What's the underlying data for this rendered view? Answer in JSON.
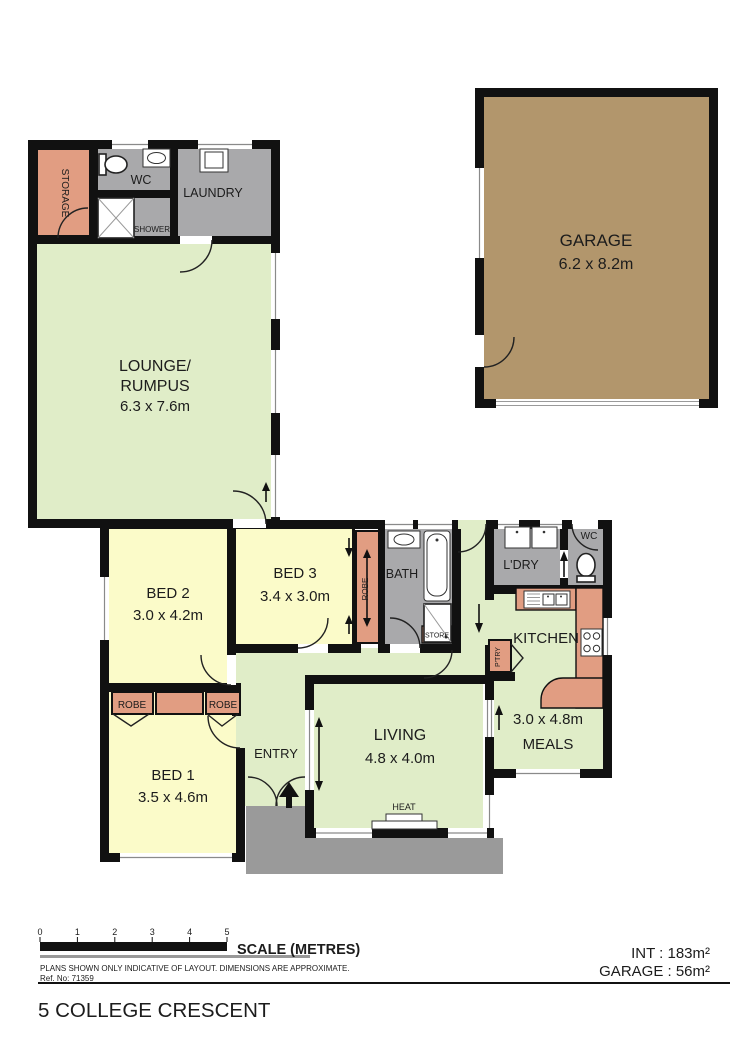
{
  "title": "5 COLLEGE CRESCENT",
  "rooms": {
    "garage": {
      "name": "GARAGE",
      "dims": "6.2 x 8.2m"
    },
    "lounge": {
      "name1": "LOUNGE/",
      "name2": "RUMPUS",
      "dims": "6.3 x 7.6m"
    },
    "storage": {
      "name": "STORAGE"
    },
    "wc_top": {
      "name": "WC"
    },
    "shower": {
      "name": "SHOWER"
    },
    "laundry": {
      "name": "LAUNDRY"
    },
    "bed1": {
      "name": "BED 1",
      "dims": "3.5 x 4.6m"
    },
    "bed2": {
      "name": "BED 2",
      "dims": "3.0 x 4.2m"
    },
    "bed3": {
      "name": "BED 3",
      "dims": "3.4 x 3.0m"
    },
    "robe1": {
      "name": "ROBE"
    },
    "robe2": {
      "name": "ROBE"
    },
    "robe3": {
      "name": "ROBE"
    },
    "bath": {
      "name": "BATH"
    },
    "store": {
      "name": "STORE"
    },
    "ldry": {
      "name": "L'DRY"
    },
    "wc2": {
      "name": "WC"
    },
    "kitchen": {
      "name": "KITCHEN"
    },
    "pantry": {
      "name": "P'TRY"
    },
    "meals": {
      "name": "MEALS",
      "dims": "3.0 x 4.8m"
    },
    "living": {
      "name": "LIVING",
      "dims": "4.8 x 4.0m"
    },
    "entry": {
      "name": "ENTRY"
    },
    "heat": {
      "name": "HEAT"
    }
  },
  "scale": {
    "label": "SCALE (METRES)",
    "ticks": [
      "0",
      "1",
      "2",
      "3",
      "4",
      "5"
    ]
  },
  "disclaimer": "PLANS SHOWN ONLY INDICATIVE OF LAYOUT.  DIMENSIONS ARE APPROXIMATE.",
  "ref": "Ref. No: 71359",
  "areas": {
    "int_line": "INT  :  183m²",
    "garage_line": "GARAGE  :  56m²"
  },
  "colors": {
    "room_green": "#e0edc8",
    "room_yellow": "#fbfbc9",
    "accent_salmon": "#e19d82",
    "room_gray": "#a9a9ab",
    "porch_gray": "#9a9a9a",
    "garage_brown": "#b2966c",
    "wall_black": "#111111"
  }
}
